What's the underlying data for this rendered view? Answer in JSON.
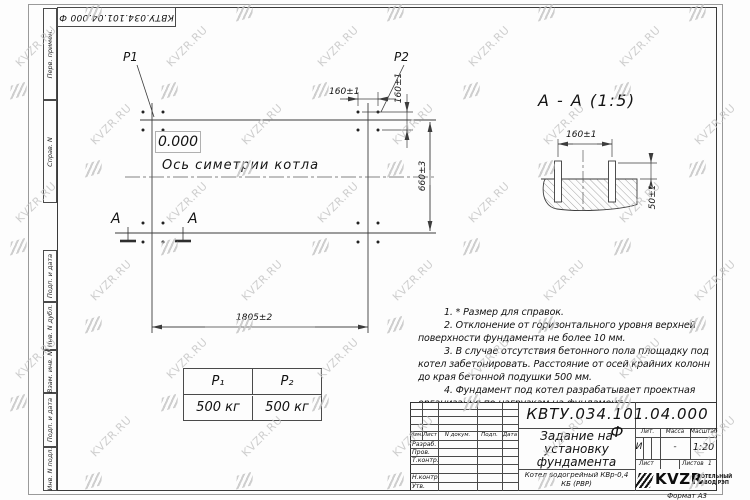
{
  "frame": {
    "stamp_text": "КВТУ.034.101.04.000 Ф",
    "column_labels": [
      "Перв. примен.",
      "Справ. N",
      "Подп. и дата",
      "Инв. N дубл.",
      "Взам. инв. N",
      "Подп. и дата",
      "Инв. N подл."
    ],
    "format_note": "Формат А3"
  },
  "watermark": {
    "text": "KVZR.RU"
  },
  "plan_view": {
    "p1_label": "P1",
    "p2_label": "P2",
    "elevation": "0.000",
    "axis_label": "Ось симетрии котла",
    "dim_length": "1805±2",
    "dim_width": "660±3",
    "dim_bolt_pitch_top": "160±1",
    "dim_bolt_pitch_side": "160±1",
    "section_mark_left": "А",
    "section_mark_right": "А"
  },
  "section_view": {
    "title": "А - А (1:5)",
    "dim_bolt_pitch": "160±1",
    "dim_bolt_height": "50±1"
  },
  "loads_table": {
    "headers": [
      "P₁",
      "P₂"
    ],
    "values": [
      "500 кг",
      "500 кг"
    ]
  },
  "notes": [
    "1. * Размер для справок.",
    "2. Отклонение от горизонтального уровня верхней поверхности фундамента не более 10 мм.",
    "3. В случае отсутствия бетонного пола площадку под котел забетонировать. Расстояние от осей крайних колонн до края бетонной подушки 500 мм.",
    "4. Фундамент под котел разрабатывает проектная организация по нагрузкам на фундамент."
  ],
  "title_block": {
    "doc_number": "КВТУ.034.101.04.000 Ф",
    "title": "Задание на установку фундамента",
    "product": "Котел водогрейный КВр-0,4 КБ (РВР)",
    "header_cols": [
      "Изм.",
      "Лист",
      "N докум.",
      "Подп.",
      "Дата"
    ],
    "signature_rows": [
      "Разраб.",
      "Пров.",
      "Т.контр.",
      "",
      "Н.контр.",
      "Утв."
    ],
    "lit_header": "Лит.",
    "mass_header": "Масса",
    "scale_header": "Масштаб",
    "lit_value": "И",
    "mass_value": "-",
    "scale_value": "1:20",
    "sheet_header": "Лист",
    "sheets_header": "Листов",
    "sheets_value": "1",
    "company": {
      "logo_text": "KVZR",
      "line1": "КОТЕЛЬНЫЙ",
      "line2": "ЗАВОД РЭП"
    }
  }
}
